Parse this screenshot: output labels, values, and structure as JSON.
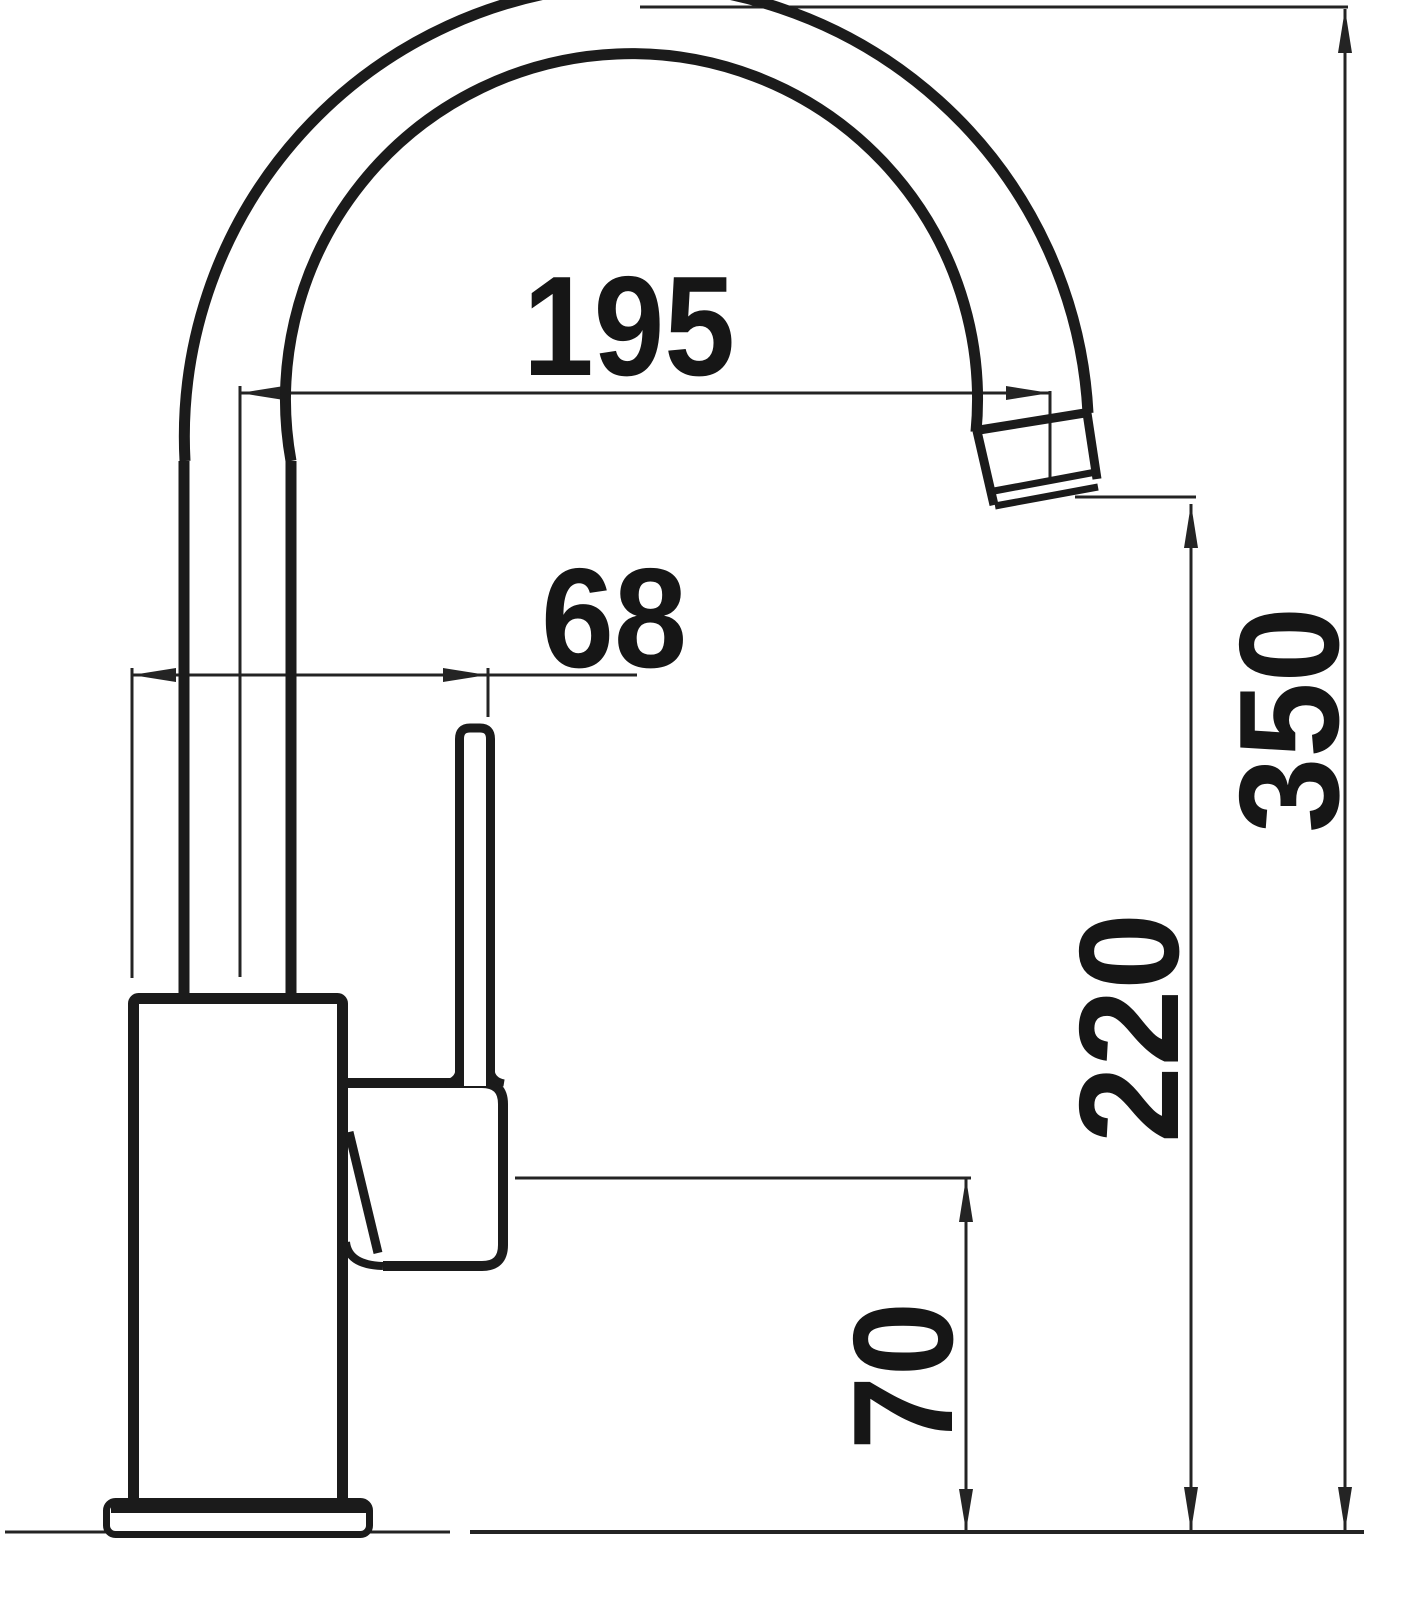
{
  "page": {
    "background": "#ffffff",
    "ink_color": "#1b1b1b"
  },
  "drawing": {
    "object": "kitchen-faucet-side-view-dimension-diagram",
    "dimensions": {
      "spout_reach": "195",
      "handle_offset": "68",
      "overall_height": "350",
      "outlet_height": "220",
      "base_to_spout_underside": "70"
    }
  }
}
